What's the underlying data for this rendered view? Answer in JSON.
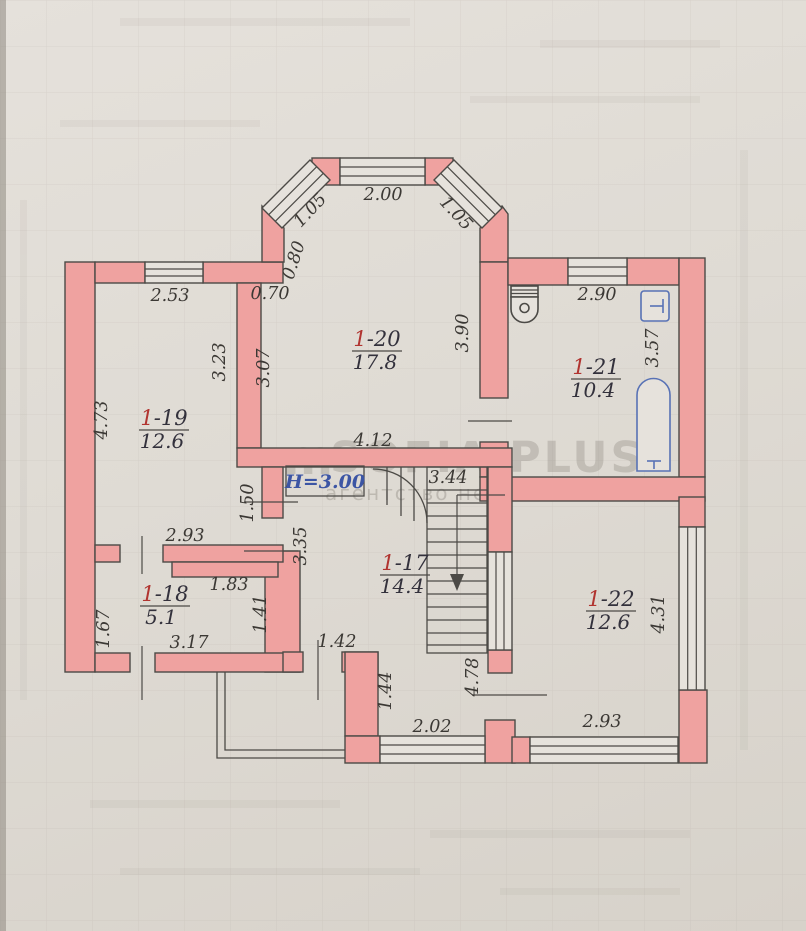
{
  "watermark": {
    "logo_glyph": "m",
    "brand": "SOFIA PLUS",
    "tagline": "агентство нерухомості"
  },
  "annotations": {
    "ceiling_height": "H=3.00"
  },
  "rooms": {
    "r17": {
      "number_prefix": "1",
      "number_suffix": "-17",
      "area": "14.4"
    },
    "r18": {
      "number_prefix": "1",
      "number_suffix": "-18",
      "area": "5.1"
    },
    "r19": {
      "number_prefix": "1",
      "number_suffix": "-19",
      "area": "12.6"
    },
    "r20": {
      "number_prefix": "1",
      "number_suffix": "-20",
      "area": "17.8"
    },
    "r21": {
      "number_prefix": "1",
      "number_suffix": "-21",
      "area": "10.4"
    },
    "r22": {
      "number_prefix": "1",
      "number_suffix": "-22",
      "area": "12.6"
    }
  },
  "dims": {
    "bay_top": "2.00",
    "bay_left": "1.05",
    "bay_right": "1.05",
    "bay_left_lower": "0.80",
    "passage_top": "0.70",
    "r19_top": "2.53",
    "r19_left": "4.73",
    "r19_right": "3.23",
    "r19_bottom": "2.93",
    "r20_left": "3.07",
    "r20_right": "3.90",
    "r20_bottom": "4.12",
    "r21_top": "2.90",
    "r21_right": "3.57",
    "stairs_width": "3.44",
    "hall_door": "1.50",
    "hall_left": "3.35",
    "hall_bottom": "1.42",
    "r18_top_inner": "1.83",
    "r18_left": "1.67",
    "r18_right": "1.41",
    "r18_bottom": "3.17",
    "vest_left": "1.44",
    "vest_bottom": "2.02",
    "stair_wall": "4.78",
    "r22_right": "4.31",
    "r22_bottom": "2.93"
  },
  "colors": {
    "wall_fill": "#efa2a0",
    "line": "#4c4a46",
    "fixture_blue": "#5872b5",
    "height_blue": "#3c55a4",
    "room_red": "#b13430",
    "paper": "#dfdbd4"
  }
}
